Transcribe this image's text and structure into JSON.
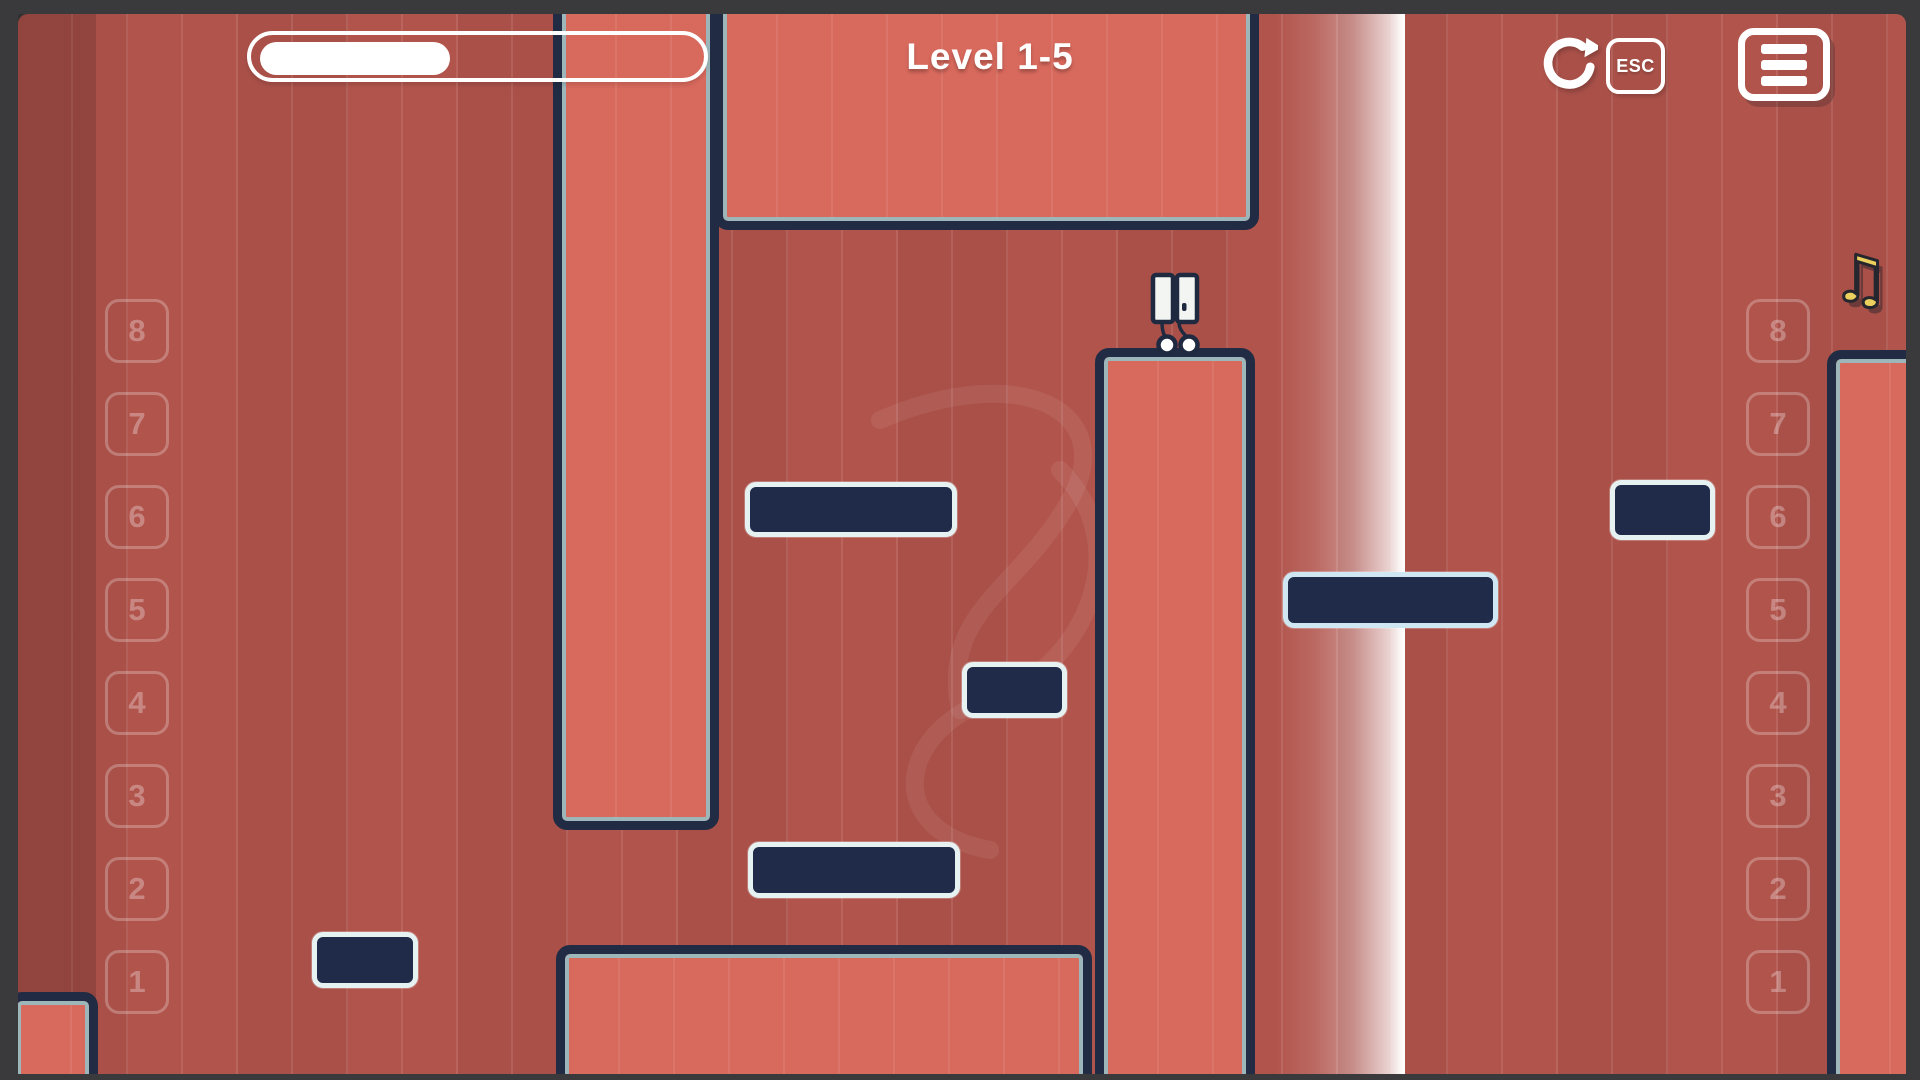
{
  "hud": {
    "title": "Level 1-5",
    "progress_pct": 42,
    "esc_label": "ESC",
    "restart_icon": "restart-icon",
    "menu_icon": "hamburger-menu-icon"
  },
  "collectible": {
    "music_note_glyph": "♫"
  },
  "beat_rows": {
    "left": [
      "8",
      "7",
      "6",
      "5",
      "4",
      "3",
      "2",
      "1"
    ],
    "right": [
      "8",
      "7",
      "6",
      "5",
      "4",
      "3",
      "2",
      "1"
    ]
  },
  "colors": {
    "frame": "#3a3a3c",
    "background_red": "#b1544c",
    "wall_fill": "#d8695d",
    "wall_outline": "#212c44",
    "wall_inner_line": "#9cb6ba",
    "platform_fill": "#1f2b49",
    "platform_border": "#e6f1f1",
    "platform_border_accent": "#cfe7f2",
    "beam": "#ffffff",
    "hud_white": "#ffffff",
    "note_yellow": "#ecd05e",
    "player_body": "#f2f5f2",
    "player_outline": "#1f2a40"
  },
  "level": {
    "walls": [
      {
        "name": "wall-top-center",
        "x": 714,
        "y": -30,
        "w": 545,
        "h": 260
      },
      {
        "name": "wall-left-column",
        "x": 553,
        "y": -30,
        "w": 166,
        "h": 860
      },
      {
        "name": "wall-bottom-center",
        "x": 556,
        "y": 945,
        "w": 536,
        "h": 165
      },
      {
        "name": "wall-center-tower",
        "x": 1095,
        "y": 348,
        "w": 160,
        "h": 762
      },
      {
        "name": "wall-right",
        "x": 1827,
        "y": 350,
        "w": 125,
        "h": 760
      },
      {
        "name": "wall-bottom-left-corner",
        "x": 8,
        "y": 992,
        "w": 90,
        "h": 118
      }
    ],
    "platforms": [
      {
        "name": "platform-left-row6",
        "x": 745,
        "y": 482,
        "w": 212,
        "h": 55
      },
      {
        "name": "platform-center-row4",
        "x": 962,
        "y": 662,
        "w": 105,
        "h": 56
      },
      {
        "name": "platform-left-row2",
        "x": 748,
        "y": 842,
        "w": 212,
        "h": 56
      },
      {
        "name": "platform-right-row5",
        "x": 1283,
        "y": 572,
        "w": 215,
        "h": 56,
        "accent": true
      },
      {
        "name": "platform-far-right-row6",
        "x": 1610,
        "y": 480,
        "w": 105,
        "h": 60
      },
      {
        "name": "platform-far-left-row1",
        "x": 312,
        "y": 932,
        "w": 106,
        "h": 56
      }
    ],
    "beam": {
      "x": 1275,
      "w": 130
    },
    "player": {
      "x": 1138,
      "y": 262
    }
  }
}
